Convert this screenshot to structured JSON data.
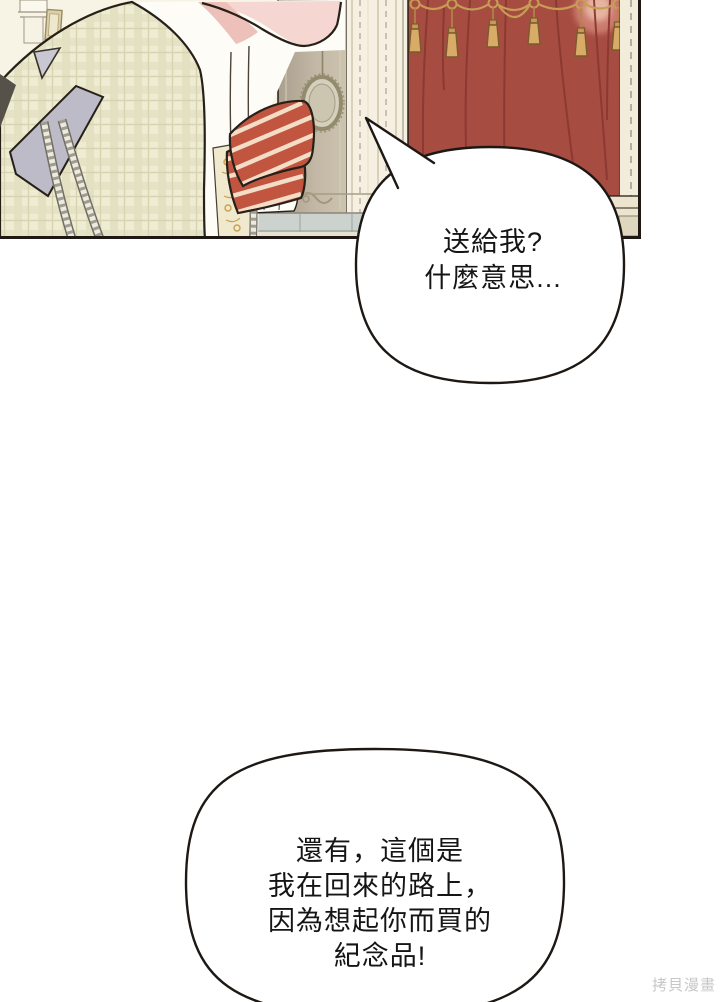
{
  "page": {
    "background": "#ffffff",
    "watermark_text": "拷貝漫畫"
  },
  "panel": {
    "type": "comic-illustration-panel",
    "colors": {
      "outline_black": "#262019",
      "wall_cream": "#f7f3e5",
      "curtain_red": "#a74c41",
      "curtain_fold": "#8a3931",
      "tassel_gold": "#d8ab67",
      "valance_gold": "#c79d56",
      "mirror_panel_tan": "#b3a796",
      "wainscot_gray": "#ccd3cf",
      "jacket_cream": "#efecd4",
      "jacket_plaid_line": "#d8d4b2",
      "sash_gray": "#bdbbc7",
      "skin_pink": "#f6d6d0",
      "skin_shadow": "#eec0ba",
      "cravat_red": "#c15540",
      "cravat_stripe": "#f3ddc7",
      "vest_gold": "#c9a050",
      "shirt_white": "#fdfcf7"
    }
  },
  "speech_bubbles": [
    {
      "id": "bubble-1",
      "lines": [
        "送給我?",
        "什麼意思..."
      ]
    },
    {
      "id": "bubble-2",
      "lines": [
        "還有，這個是",
        "我在回來的路上，",
        "因為想起你而買的",
        "紀念品!"
      ]
    }
  ]
}
